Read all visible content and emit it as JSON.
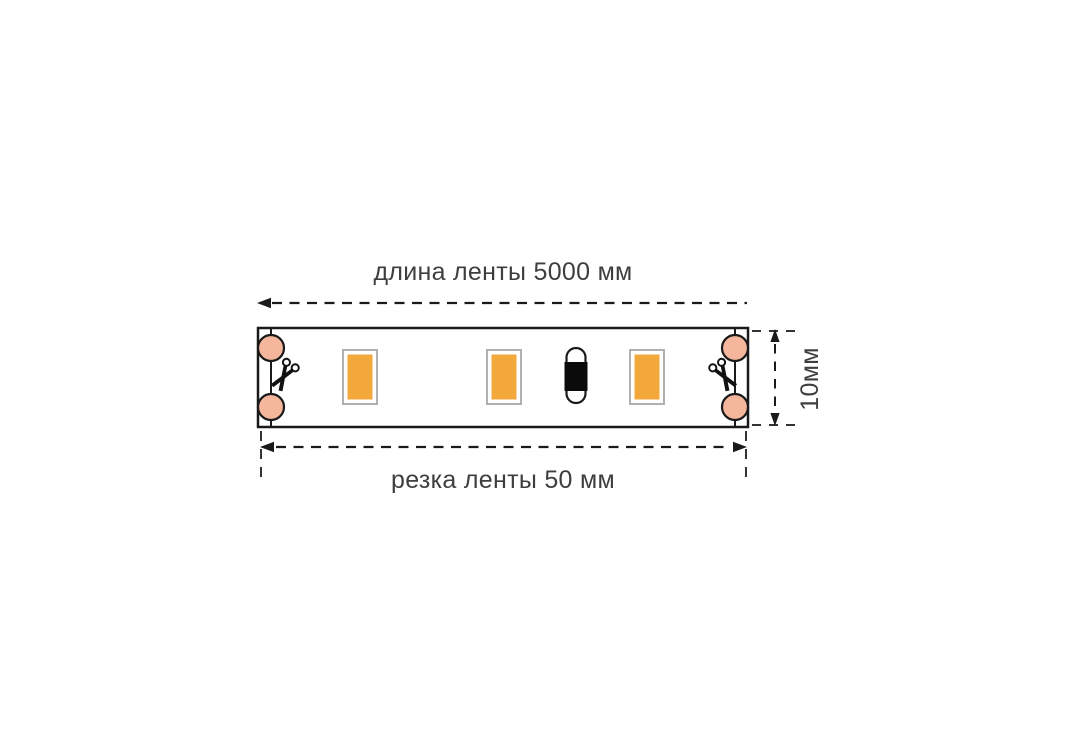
{
  "diagram": {
    "top_dimension_label": "длина ленты 5000 мм",
    "bottom_dimension_label": "резка ленты 50 мм",
    "width_dimension_label": "10мм",
    "led_count": 3,
    "solder_pad_count": 4,
    "colors": {
      "led_fill": "#F3A83C",
      "led_border": "#B0B0B0",
      "pad_fill": "#F4B79C",
      "resistor_fill": "#0B0B0B",
      "line_color": "#1A1A1A",
      "text_color": "#3E3E3E",
      "background": "#FFFFFF"
    }
  }
}
